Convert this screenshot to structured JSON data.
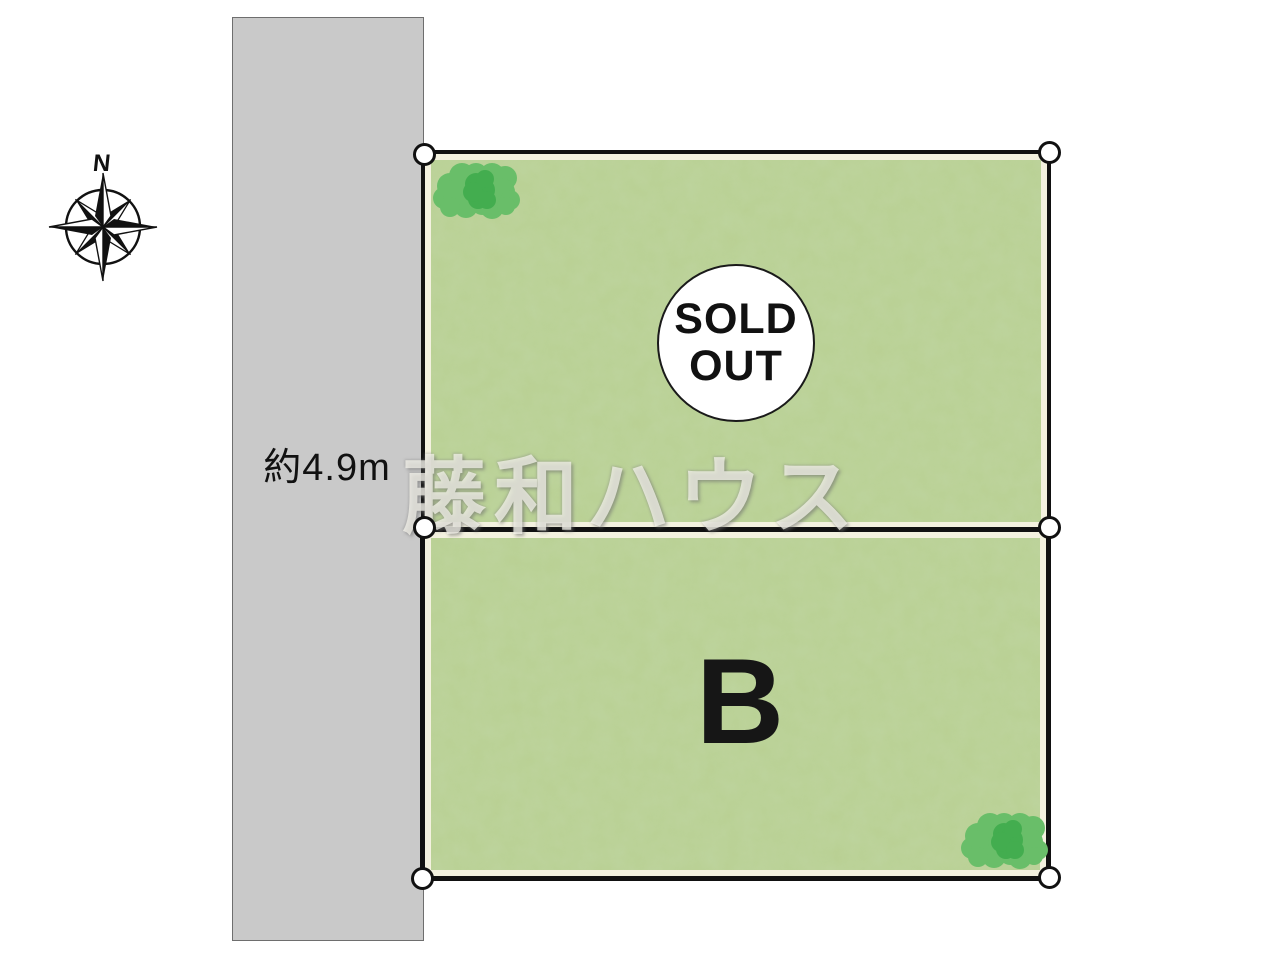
{
  "compass": {
    "north_label": "N"
  },
  "road": {
    "width_label": "約4.9m",
    "color": "#c9c9c9"
  },
  "watermark": {
    "text": "藤和ハウス"
  },
  "plots": {
    "a": {
      "status_line1": "SOLD",
      "status_line2": "OUT"
    },
    "b": {
      "label": "B"
    }
  },
  "colors": {
    "road": "#c9c9c9",
    "ground_base": "#b9d093",
    "ground_inset": "#f3f1df",
    "border": "#111111",
    "tree_light": "#69be69",
    "tree_dark": "#43ad4f",
    "sold_circle_bg": "#ffffff",
    "marker_bg": "#ffffff"
  }
}
